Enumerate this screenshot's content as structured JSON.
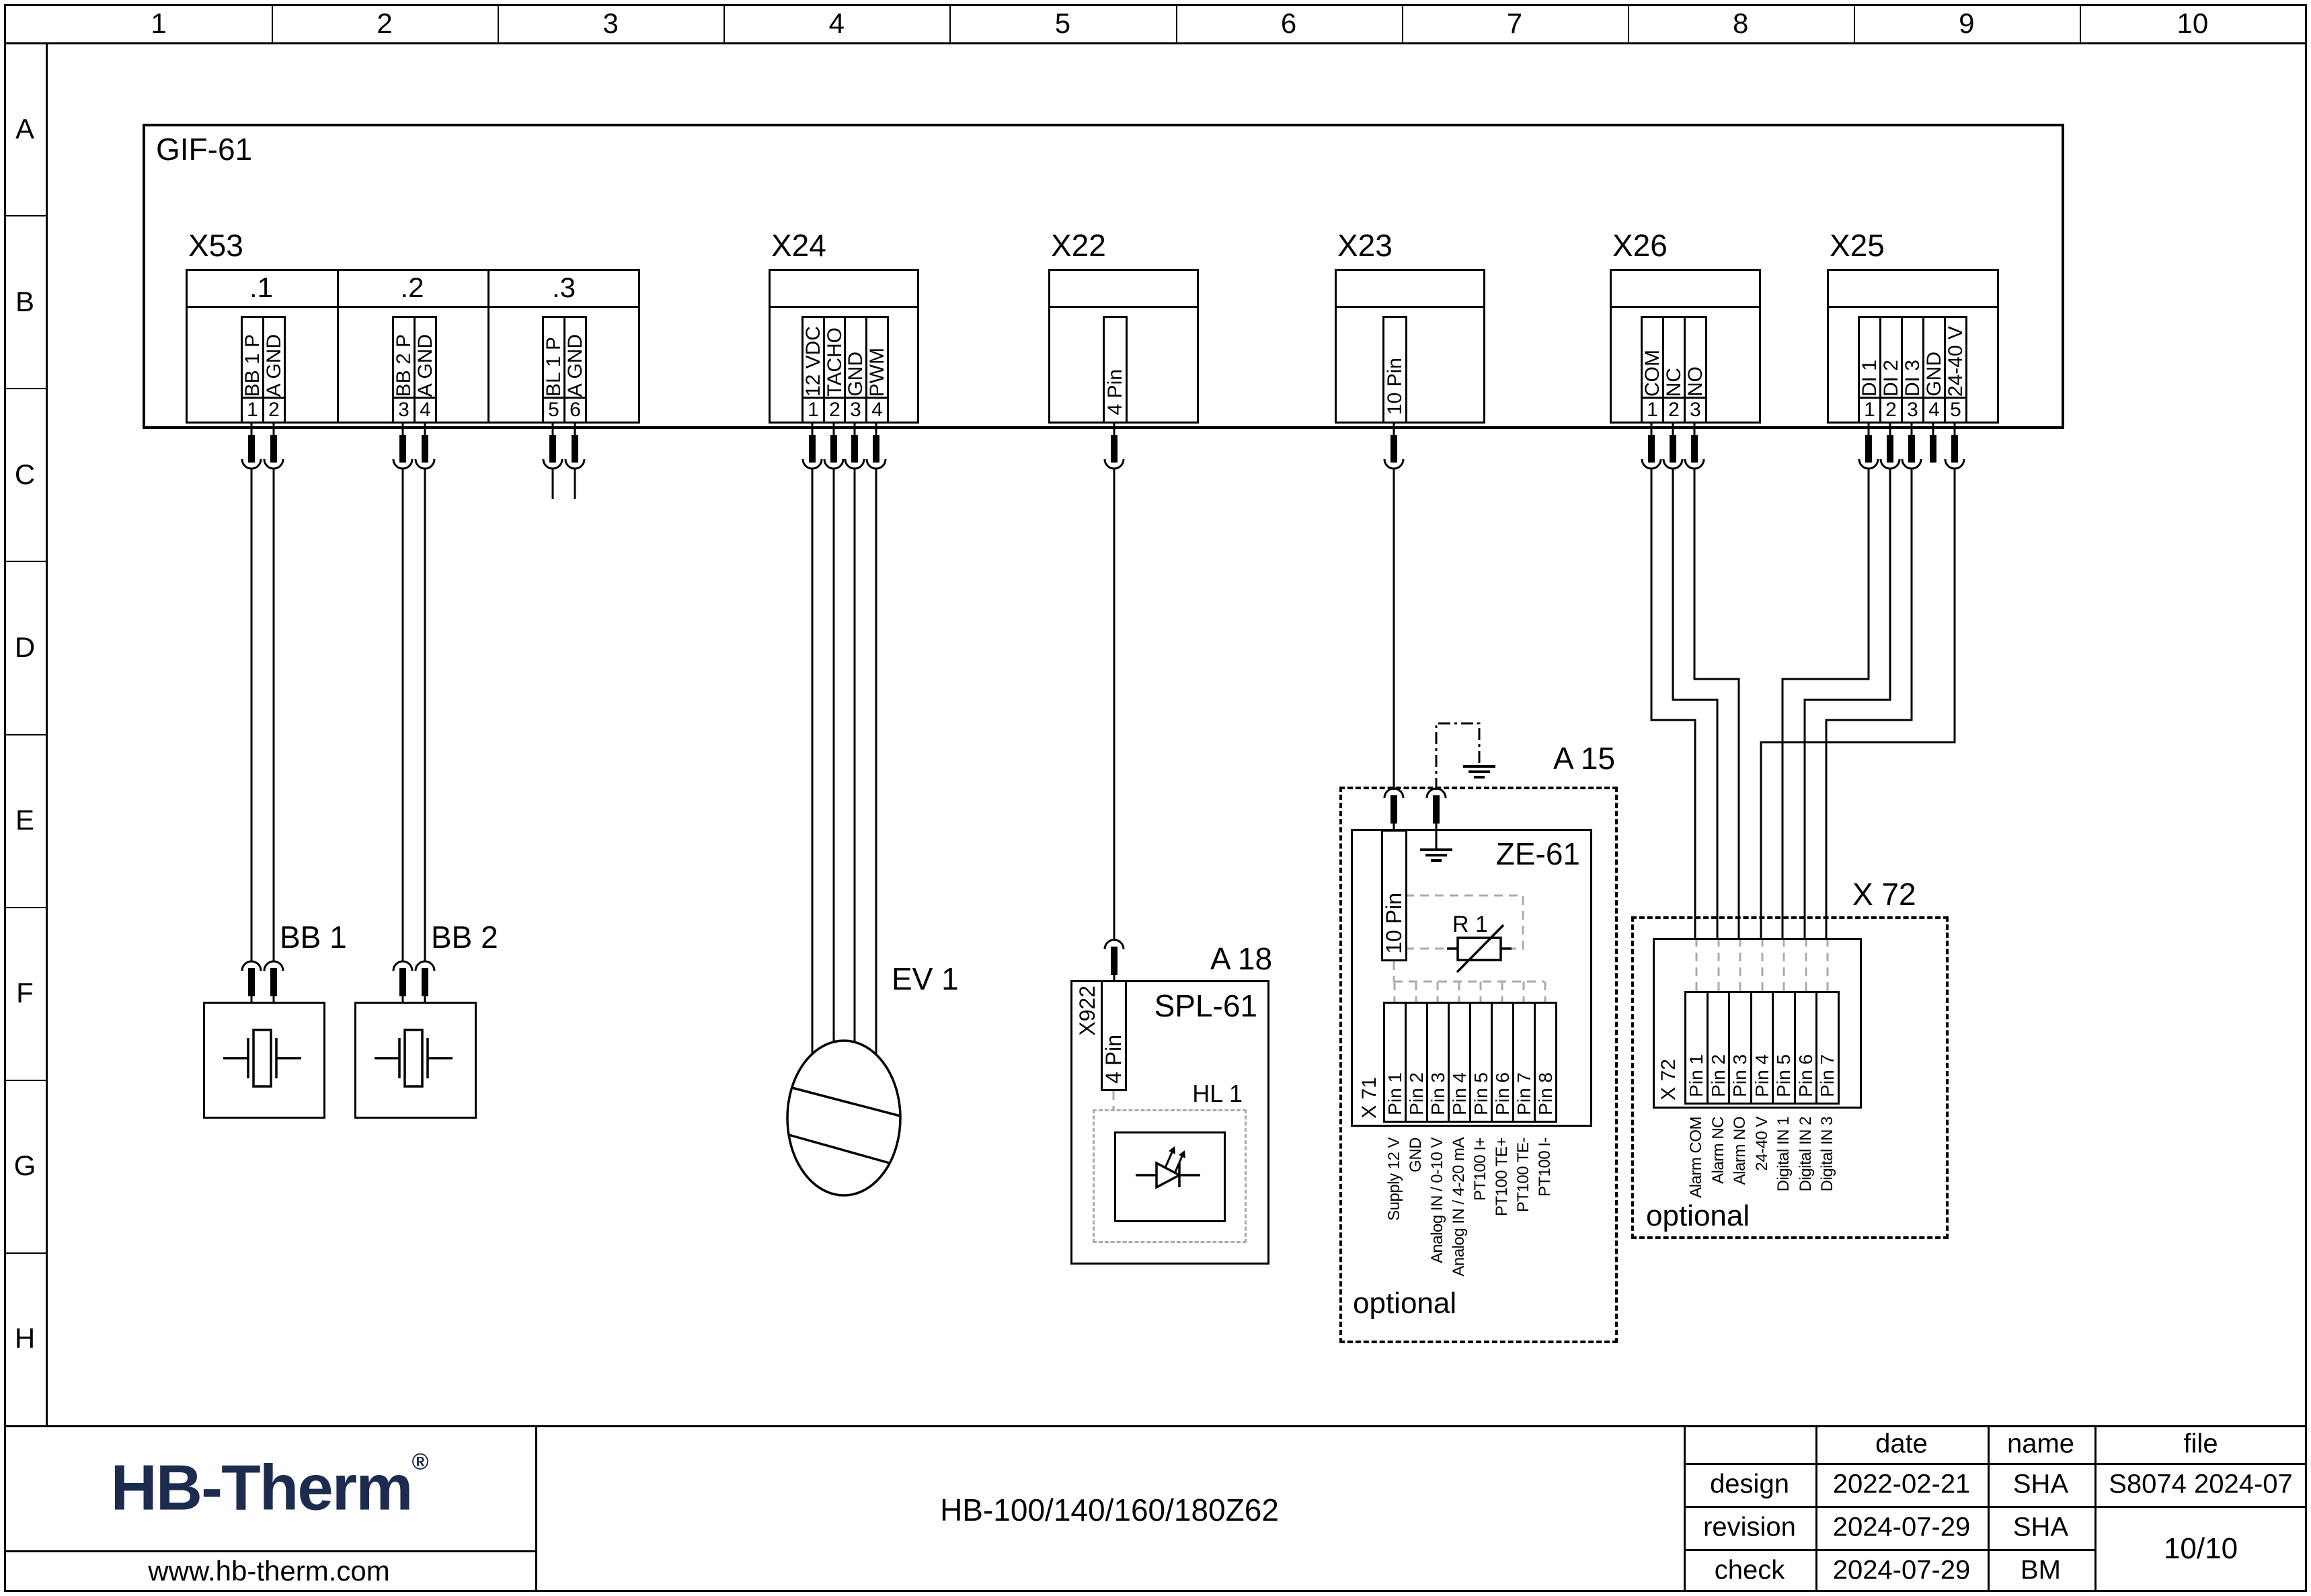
{
  "grid": {
    "columns": [
      "1",
      "2",
      "3",
      "4",
      "5",
      "6",
      "7",
      "8",
      "9",
      "10"
    ],
    "rows": [
      "A",
      "B",
      "C",
      "D",
      "E",
      "F",
      "G",
      "H"
    ]
  },
  "board": {
    "label": "GIF-61"
  },
  "connectors": [
    {
      "id": "X53",
      "label": "X53",
      "sections": [
        ".1",
        ".2",
        ".3"
      ],
      "pins": [
        {
          "num": "1",
          "label": "BB 1 P"
        },
        {
          "num": "2",
          "label": "A GND"
        },
        {
          "num": "3",
          "label": "BB 2 P"
        },
        {
          "num": "4",
          "label": "A GND"
        },
        {
          "num": "5",
          "label": "BL 1 P"
        },
        {
          "num": "6",
          "label": "A GND"
        }
      ]
    },
    {
      "id": "X24",
      "label": "X24",
      "pins": [
        {
          "num": "1",
          "label": "12 VDC"
        },
        {
          "num": "2",
          "label": "TACHO"
        },
        {
          "num": "3",
          "label": "GND"
        },
        {
          "num": "4",
          "label": "PWM"
        }
      ]
    },
    {
      "id": "X22",
      "label": "X22",
      "pins": [
        {
          "num": "",
          "label": "4 Pin"
        }
      ]
    },
    {
      "id": "X23",
      "label": "X23",
      "pins": [
        {
          "num": "",
          "label": "10 Pin"
        }
      ]
    },
    {
      "id": "X26",
      "label": "X26",
      "pins": [
        {
          "num": "1",
          "label": "COM"
        },
        {
          "num": "2",
          "label": "NC"
        },
        {
          "num": "3",
          "label": "NO"
        }
      ]
    },
    {
      "id": "X25",
      "label": "X25",
      "pins": [
        {
          "num": "1",
          "label": "DI 1"
        },
        {
          "num": "2",
          "label": "DI 2"
        },
        {
          "num": "3",
          "label": "DI 3"
        },
        {
          "num": "4",
          "label": "GND"
        },
        {
          "num": "5",
          "label": "24-40 V"
        }
      ]
    }
  ],
  "devices": {
    "bb1": {
      "label": "BB 1"
    },
    "bb2": {
      "label": "BB 2"
    },
    "ev1": {
      "label": "EV 1"
    },
    "a18": {
      "label": "A 18",
      "module": "SPL-61",
      "connector": "X922",
      "connector_pins": "4 Pin",
      "lamp": "HL 1"
    },
    "a15": {
      "label": "A 15",
      "module": "ZE-61",
      "connector_pins": "10 Pin",
      "resistor": "R 1",
      "optional": "optional",
      "x71": {
        "label": "X 71",
        "pins": [
          "Pin 1",
          "Pin 2",
          "Pin 3",
          "Pin 4",
          "Pin 5",
          "Pin 6",
          "Pin 7",
          "Pin 8"
        ],
        "functions": [
          "Supply 12 V",
          "GND",
          "Analog IN / 0-10 V",
          "Analog IN / 4-20 mA",
          "PT100 I+",
          "PT100 TE+",
          "PT100 TE-",
          "PT100 I-"
        ]
      }
    },
    "x72": {
      "label": "X 72",
      "optional": "optional",
      "connector": {
        "label": "X 72",
        "pins": [
          "Pin 1",
          "Pin 2",
          "Pin 3",
          "Pin 4",
          "Pin 5",
          "Pin 6",
          "Pin 7"
        ],
        "functions": [
          "Alarm COM",
          "Alarm NC",
          "Alarm NO",
          "24-40 V",
          "Digital IN 1",
          "Digital IN 2",
          "Digital IN 3"
        ]
      }
    }
  },
  "title_block": {
    "logo": "HB-Therm",
    "logo_reg": "®",
    "website": "www.hb-therm.com",
    "drawing_title": "HB-100/140/160/180Z62",
    "headers": {
      "date": "date",
      "name": "name",
      "file": "file"
    },
    "rows": [
      {
        "label": "design",
        "date": "2022-02-21",
        "name": "SHA",
        "file": "S8074 2024-07"
      },
      {
        "label": "revision",
        "date": "2024-07-29",
        "name": "SHA",
        "file": ""
      },
      {
        "label": "check",
        "date": "2024-07-29",
        "name": "BM",
        "file": ""
      }
    ],
    "page": "10/10"
  },
  "colors": {
    "line": "#000000",
    "gray": "#ababab",
    "logo": "#1d2b4f"
  }
}
